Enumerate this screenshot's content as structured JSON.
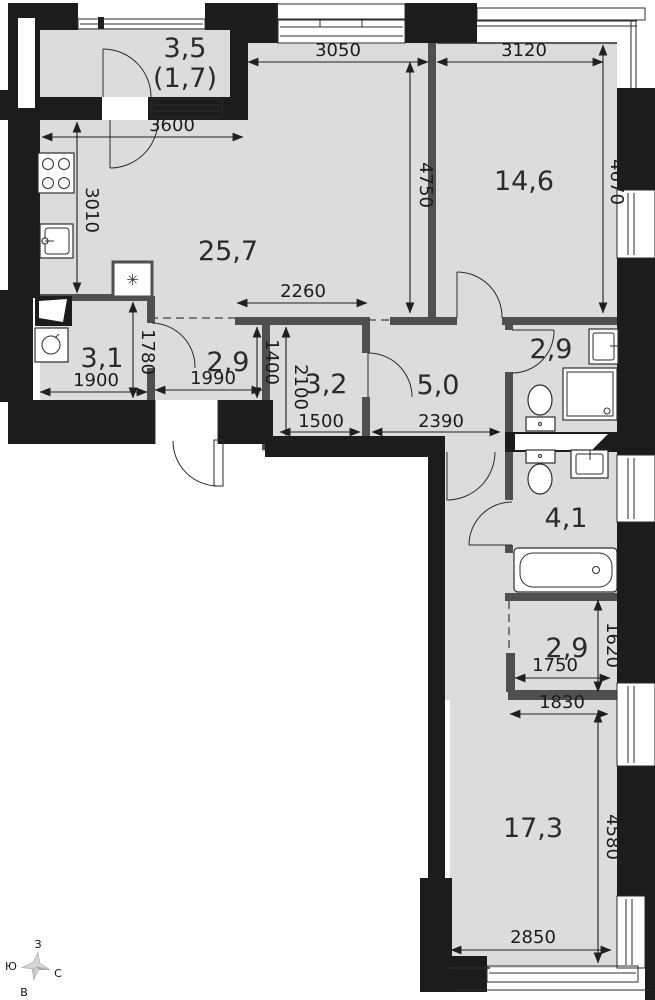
{
  "rooms": {
    "loggia": {
      "area": "3,5",
      "area_reduced": "(1,7)"
    },
    "kitchen_living": {
      "area": "25,7"
    },
    "bedroom": {
      "area": "14,6"
    },
    "bathroom_guest": {
      "area": "3,1"
    },
    "hallway": {
      "area": "2,9"
    },
    "storage": {
      "area": "3,2"
    },
    "hall": {
      "area": "5,0"
    },
    "shower_room": {
      "area": "2,9"
    },
    "bathroom_master": {
      "area": "4,1"
    },
    "wardrobe": {
      "area": "2,9"
    },
    "bedroom_2": {
      "area": "17,3"
    }
  },
  "dimensions_mm": {
    "loggia_width": "3600",
    "kitchen_depth": "3010",
    "living_width": "3050",
    "bedroom_width": "3120",
    "living_depth": "4750",
    "bedroom_depth": "4670",
    "hall_top_width": "2260",
    "bath_guest_width": "1900",
    "bath_guest_depth": "1780",
    "hallway_width": "1990",
    "hallway_depth": "1400",
    "storage_depth": "2100",
    "storage_width": "1500",
    "hall_width": "2390",
    "wardrobe_depth": "1620",
    "wardrobe_width": "1750",
    "bedroom2_top_width": "1830",
    "bedroom2_depth": "4580",
    "bedroom2_width": "2850"
  },
  "compass": {
    "west": "З",
    "south": "Ю",
    "north": "С",
    "east": "В"
  },
  "shaft_symbol": "✳",
  "colors": {
    "floor": "#dcdcdc",
    "wall_exterior": "#1c1c1c",
    "wall_interior": "#4f4f4f",
    "line": "#2b2b2b",
    "dimension": "#1f1f1f"
  }
}
